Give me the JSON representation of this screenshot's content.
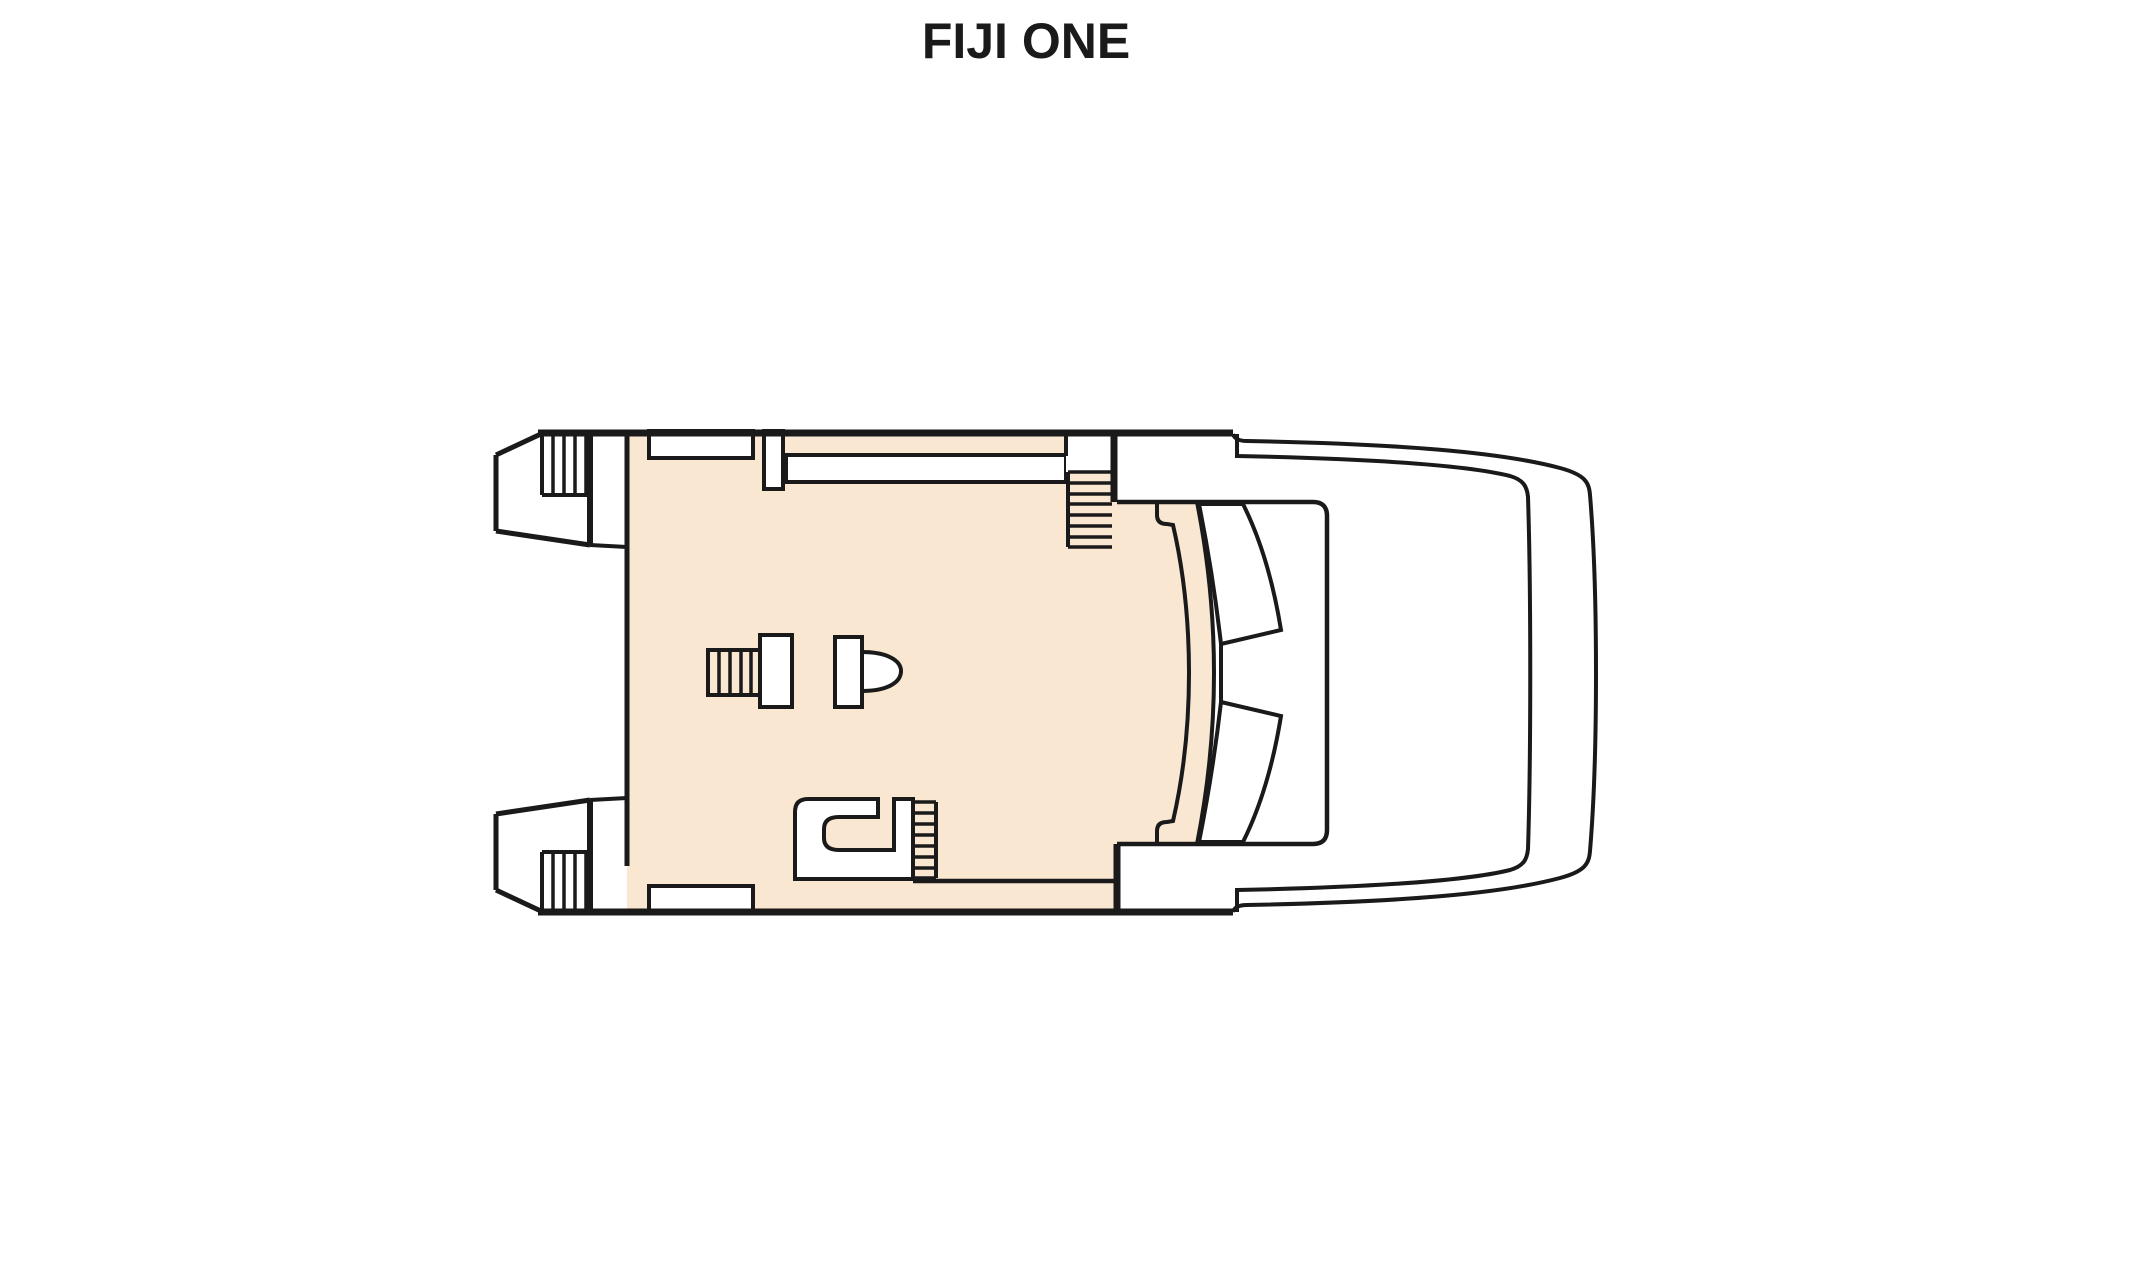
{
  "title": {
    "text": "FIJI ONE"
  },
  "colors": {
    "background": "#ffffff",
    "deck": "#FAE7D1",
    "hull": "#ffffff",
    "line": "#1a1a1a"
  },
  "diagram": {
    "type": "boat-deck-plan",
    "vessel_name": "FIJI ONE",
    "parts": [
      "flybridge-deck",
      "port-swim-platform",
      "port-platform-steps",
      "starboard-swim-platform",
      "starboard-platform-steps",
      "aft-bench-port",
      "aft-bench-starboard",
      "windbreak-partition",
      "sun-lounger",
      "side-deck-stairs",
      "deck-bulkhead",
      "helm-grill",
      "helm-console",
      "helm-seat",
      "wet-bar",
      "aft-deck-stairs",
      "foredeck-seat-back",
      "windshield-frame",
      "windshield-supports",
      "bow-rail-outer",
      "bow-rail-inner"
    ]
  }
}
